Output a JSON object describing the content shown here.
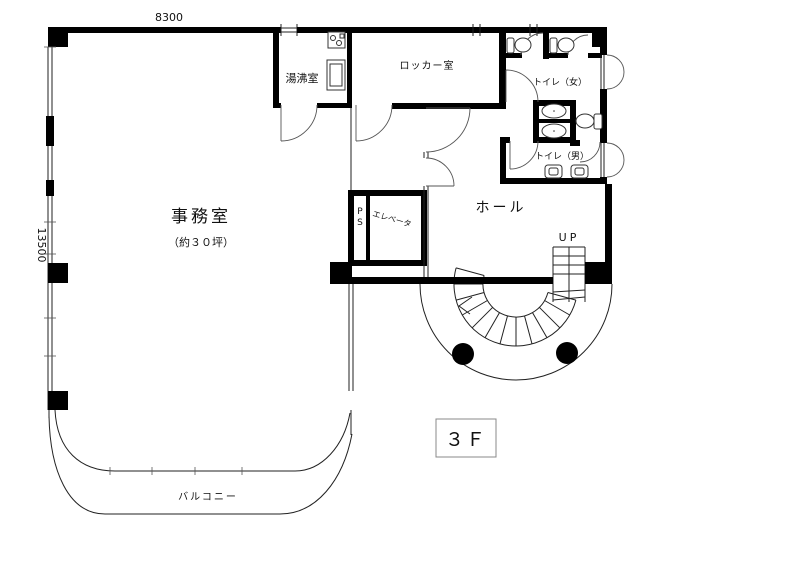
{
  "floor": {
    "label": "３Ｆ"
  },
  "dimensions": {
    "top": "8300",
    "left": "13500"
  },
  "rooms": {
    "office": {
      "name": "事務室",
      "area": "（約３０坪）"
    },
    "kitchenette": {
      "name": "湯沸室"
    },
    "locker_room": {
      "name": "ロッカー室"
    },
    "toilet_women": {
      "name": "トイレ（女）"
    },
    "toilet_men": {
      "name": "トイレ（男）"
    },
    "hall": {
      "name": "ホール"
    },
    "elevator": {
      "name": "エレベータ"
    },
    "pipe_shaft": {
      "name": "PS"
    },
    "balcony": {
      "name": "バルコニー"
    }
  },
  "stairs": {
    "up_label": "UP"
  },
  "colors": {
    "wall": "#000000",
    "line": "#222222",
    "background": "#ffffff"
  }
}
